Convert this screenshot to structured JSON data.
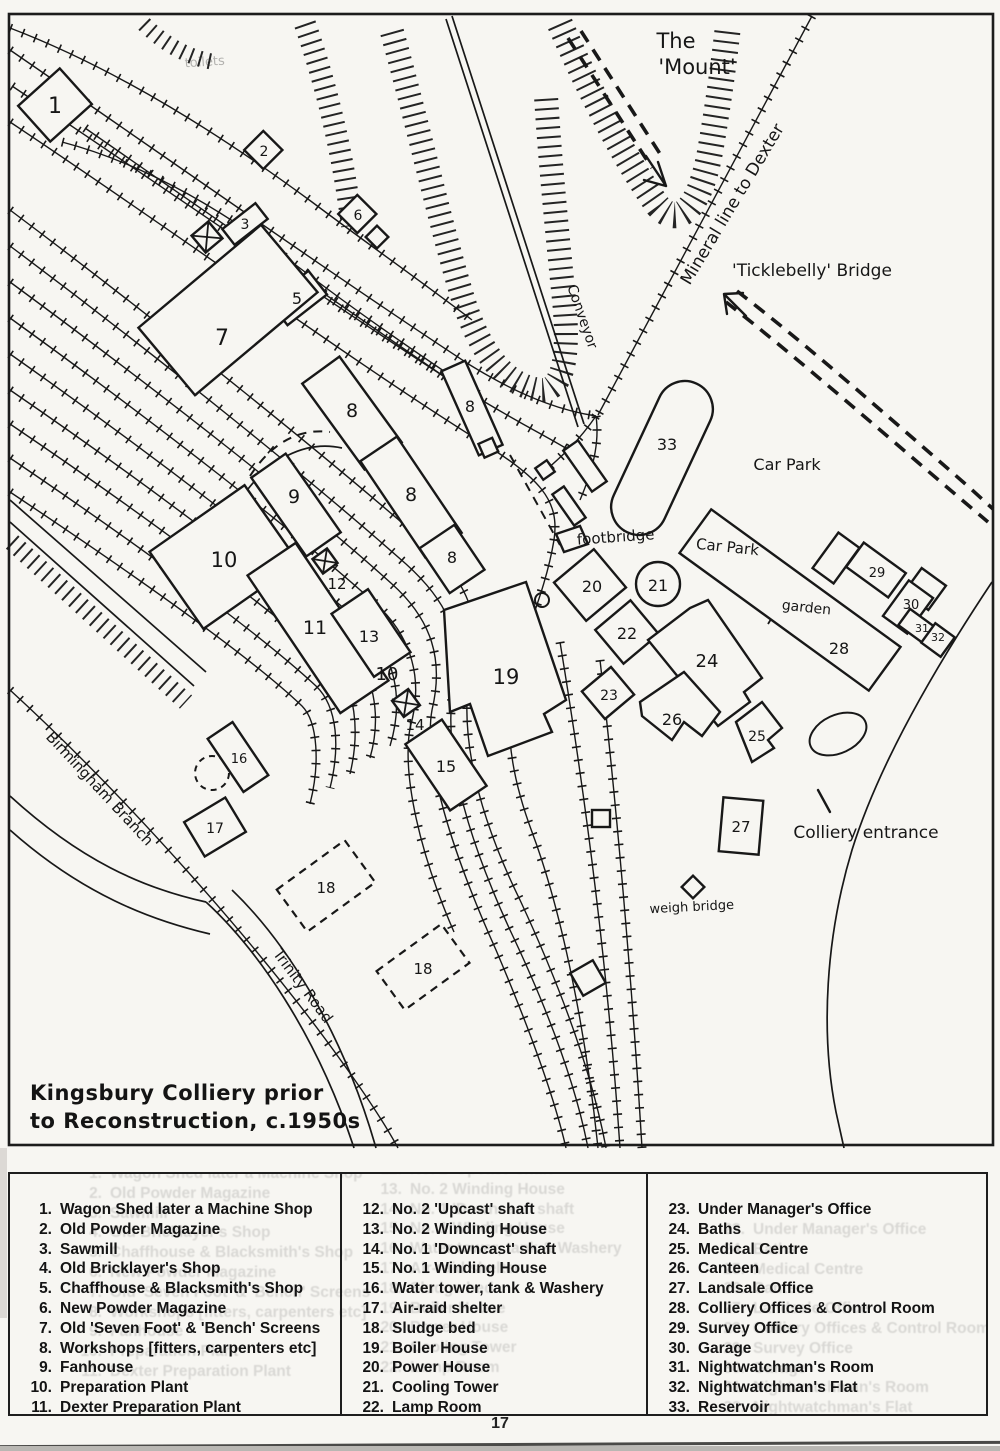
{
  "page": {
    "number": "17"
  },
  "map": {
    "title": {
      "line1": "Kingsbury Colliery prior",
      "line2": "to Reconstruction, c.1950s"
    },
    "labels": [
      {
        "id": "the-mount-line1",
        "text": "The",
        "x": 676,
        "y": 48,
        "rot": 0,
        "fs": 21
      },
      {
        "id": "the-mount-line2",
        "text": "'Mount'",
        "x": 697,
        "y": 74,
        "rot": 0,
        "fs": 21
      },
      {
        "id": "mineral-line-to-dexter",
        "text": "Mineral line to Dexter",
        "x": 737,
        "y": 207,
        "rot": -59,
        "fs": 17
      },
      {
        "id": "ticklebelly-bridge",
        "text": "'Ticklebelly' Bridge",
        "x": 812,
        "y": 276,
        "rot": 0,
        "fs": 17
      },
      {
        "id": "conveyor",
        "text": "Conveyor",
        "x": 578,
        "y": 318,
        "rot": 71,
        "fs": 14
      },
      {
        "id": "car-park-upper",
        "text": "Car Park",
        "x": 787,
        "y": 470,
        "rot": 0,
        "fs": 16
      },
      {
        "id": "car-park-lower",
        "text": "Car Park",
        "x": 727,
        "y": 552,
        "rot": 6,
        "fs": 15
      },
      {
        "id": "footbridge",
        "text": "footbridge",
        "x": 616,
        "y": 542,
        "rot": -4,
        "fs": 15
      },
      {
        "id": "garden",
        "text": "garden",
        "x": 806,
        "y": 612,
        "rot": 6,
        "fs": 14
      },
      {
        "id": "colliery-entrance",
        "text": "Colliery entrance",
        "x": 866,
        "y": 838,
        "rot": 0,
        "fs": 17
      },
      {
        "id": "weigh-bridge",
        "text": "weigh bridge",
        "x": 692,
        "y": 911,
        "rot": -3,
        "fs": 13
      },
      {
        "id": "birmingham-branch",
        "text": "Birmingham Branch",
        "x": 96,
        "y": 792,
        "rot": 47,
        "fs": 15
      },
      {
        "id": "trinity-road",
        "text": "Trinity Road",
        "x": 299,
        "y": 989,
        "rot": 53,
        "fs": 15
      },
      {
        "id": "toilets",
        "text": "toilets",
        "x": 205,
        "y": 66,
        "rot": -4,
        "fs": 13,
        "faint": true
      }
    ],
    "building_markers": [
      {
        "n": "1",
        "x": 55,
        "y": 113,
        "fs": 22
      },
      {
        "n": "2",
        "x": 264,
        "y": 156,
        "fs": 14
      },
      {
        "n": "3",
        "x": 245,
        "y": 229,
        "fs": 14
      },
      {
        "n": "5",
        "x": 297,
        "y": 304,
        "fs": 16
      },
      {
        "n": "6",
        "x": 358,
        "y": 220,
        "fs": 14
      },
      {
        "n": "7",
        "x": 222,
        "y": 345,
        "fs": 22
      },
      {
        "n": "8",
        "x": 352,
        "y": 417,
        "fs": 19
      },
      {
        "n": "8",
        "x": 470,
        "y": 412,
        "fs": 16
      },
      {
        "n": "8",
        "x": 411,
        "y": 501,
        "fs": 19
      },
      {
        "n": "8",
        "x": 452,
        "y": 563,
        "fs": 16
      },
      {
        "n": "9",
        "x": 294,
        "y": 503,
        "fs": 19
      },
      {
        "n": "10",
        "x": 224,
        "y": 567,
        "fs": 21
      },
      {
        "n": "11",
        "x": 315,
        "y": 634,
        "fs": 19
      },
      {
        "n": "12",
        "x": 337,
        "y": 589,
        "fs": 15
      },
      {
        "n": "13",
        "x": 369,
        "y": 642,
        "fs": 16
      },
      {
        "n": "10",
        "x": 387,
        "y": 680,
        "fs": 18
      },
      {
        "n": "14",
        "x": 415,
        "y": 730,
        "fs": 15
      },
      {
        "n": "15",
        "x": 446,
        "y": 772,
        "fs": 16
      },
      {
        "n": "16",
        "x": 239,
        "y": 763,
        "fs": 13
      },
      {
        "n": "17",
        "x": 215,
        "y": 833,
        "fs": 14
      },
      {
        "n": "18",
        "x": 326,
        "y": 893,
        "fs": 15
      },
      {
        "n": "18",
        "x": 423,
        "y": 974,
        "fs": 15
      },
      {
        "n": "19",
        "x": 506,
        "y": 684,
        "fs": 21
      },
      {
        "n": "20",
        "x": 592,
        "y": 592,
        "fs": 16
      },
      {
        "n": "21",
        "x": 658,
        "y": 591,
        "fs": 16
      },
      {
        "n": "22",
        "x": 627,
        "y": 639,
        "fs": 16
      },
      {
        "n": "23",
        "x": 609,
        "y": 700,
        "fs": 14
      },
      {
        "n": "24",
        "x": 707,
        "y": 667,
        "fs": 18
      },
      {
        "n": "25",
        "x": 757,
        "y": 741,
        "fs": 14
      },
      {
        "n": "26",
        "x": 672,
        "y": 725,
        "fs": 16
      },
      {
        "n": "27",
        "x": 741,
        "y": 832,
        "fs": 15
      },
      {
        "n": "28",
        "x": 839,
        "y": 654,
        "fs": 16
      },
      {
        "n": "29",
        "x": 877,
        "y": 577,
        "fs": 13
      },
      {
        "n": "30",
        "x": 911,
        "y": 609,
        "fs": 13
      },
      {
        "n": "31",
        "x": 922,
        "y": 632,
        "fs": 11
      },
      {
        "n": "32",
        "x": 938,
        "y": 641,
        "fs": 11
      },
      {
        "n": "33",
        "x": 667,
        "y": 450,
        "fs": 16
      }
    ]
  },
  "legend": {
    "columns": [
      {
        "items": [
          {
            "n": "1.",
            "text": "Wagon Shed later a Machine Shop"
          },
          {
            "n": "2.",
            "text": "Old Powder Magazine"
          },
          {
            "n": "3.",
            "text": "Sawmill"
          },
          {
            "n": "4.",
            "text": "Old Bricklayer's Shop"
          },
          {
            "n": "5.",
            "text": "Chaffhouse & Blacksmith's Shop"
          },
          {
            "n": "6.",
            "text": "New Powder Magazine"
          },
          {
            "n": "7.",
            "text": "Old 'Seven Foot' & 'Bench' Screens"
          },
          {
            "n": "8.",
            "text": "Workshops [fitters, carpenters etc]"
          },
          {
            "n": "9.",
            "text": "Fanhouse"
          },
          {
            "n": "10.",
            "text": "Preparation Plant"
          },
          {
            "n": "11.",
            "text": "Dexter Preparation Plant"
          }
        ]
      },
      {
        "items": [
          {
            "n": "12.",
            "text": "No. 2 'Upcast' shaft"
          },
          {
            "n": "13.",
            "text": "No. 2 Winding House"
          },
          {
            "n": "14.",
            "text": "No. 1 'Downcast' shaft"
          },
          {
            "n": "15.",
            "text": "No. 1 Winding House"
          },
          {
            "n": "16.",
            "text": "Water tower, tank & Washery"
          },
          {
            "n": "17.",
            "text": "Air-raid shelter"
          },
          {
            "n": "18.",
            "text": "Sludge bed"
          },
          {
            "n": "19.",
            "text": "Boiler House"
          },
          {
            "n": "20.",
            "text": "Power House"
          },
          {
            "n": "21.",
            "text": "Cooling Tower"
          },
          {
            "n": "22.",
            "text": "Lamp Room"
          }
        ]
      },
      {
        "items": [
          {
            "n": "23.",
            "text": "Under Manager's Office"
          },
          {
            "n": "24.",
            "text": "Baths"
          },
          {
            "n": "25.",
            "text": "Medical Centre"
          },
          {
            "n": "26.",
            "text": "Canteen"
          },
          {
            "n": "27.",
            "text": "Landsale Office"
          },
          {
            "n": "28.",
            "text": "Colliery Offices & Control Room"
          },
          {
            "n": "29.",
            "text": "Survey Office"
          },
          {
            "n": "30.",
            "text": "Garage"
          },
          {
            "n": "31.",
            "text": "Nightwatchman's Room"
          },
          {
            "n": "32.",
            "text": "Nightwatchman's Flat"
          },
          {
            "n": "33.",
            "text": "Reservoir"
          }
        ]
      }
    ]
  }
}
